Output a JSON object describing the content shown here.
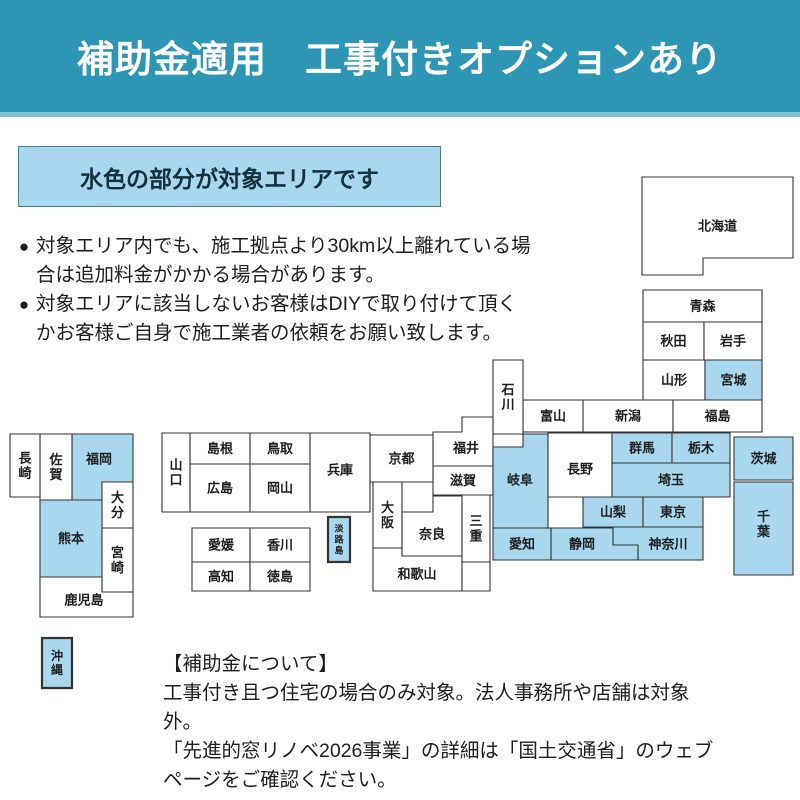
{
  "banner": {
    "title": "補助金適用　工事付きオプションあり"
  },
  "legend": {
    "label": "水色の部分が対象エリアです",
    "meaning": "light-blue boxes = service target area"
  },
  "notes": {
    "items": [
      "対象エリア内でも、施工拠点より30km以上離れている場合は追加料金がかかる場合があります。",
      "対象エリアに該当しないお客様はDIYで取り付けて頂くかお客様ご自身で施工業者の依頼をお願い致します。"
    ],
    "bullet": "●"
  },
  "footer": {
    "heading": "【補助金について】",
    "body": "工事付き且つ住宅の場合のみ対象。法人事務所や店舗は対象外。\n「先進的窓リノベ2026事業」の詳細は「国土交通省」のウェブ\nページをご確認ください。"
  },
  "theme": {
    "banner_bg": "#2e96b5",
    "banner_text": "#ffffff",
    "target_area_fill": "#a9d8ee",
    "default_fill": "#ffffff",
    "border": "#333333",
    "text": "#1e1e1e"
  },
  "map": {
    "description": "schematic block map of Japan prefectures; fill 'target' = covered area",
    "prefectures": [
      {
        "id": "hokkaido",
        "name": "北海道",
        "points": [
          [
            642,
            177
          ],
          [
            793,
            177
          ],
          [
            793,
            258
          ],
          [
            703,
            258
          ],
          [
            703,
            275
          ],
          [
            642,
            275
          ]
        ],
        "fill": "default"
      },
      {
        "id": "aomori",
        "name": "青森",
        "rect": [
          643,
          290,
          762,
          322
        ],
        "fill": "default"
      },
      {
        "id": "akita",
        "name": "秋田",
        "rect": [
          643,
          322,
          704,
          360
        ],
        "fill": "default"
      },
      {
        "id": "iwate",
        "name": "岩手",
        "rect": [
          704,
          322,
          762,
          360
        ],
        "fill": "default"
      },
      {
        "id": "yamagata",
        "name": "山形",
        "rect": [
          643,
          360,
          705,
          400
        ],
        "fill": "default"
      },
      {
        "id": "miyagi",
        "name": "宮城",
        "rect": [
          705,
          360,
          762,
          400
        ],
        "fill": "target"
      },
      {
        "id": "niigata",
        "name": "新潟",
        "rect": [
          583,
          400,
          673,
          432
        ],
        "fill": "default"
      },
      {
        "id": "toyama",
        "name": "富山",
        "rect": [
          523,
          400,
          583,
          432
        ],
        "fill": "default"
      },
      {
        "id": "fukushima",
        "name": "福島",
        "rect": [
          673,
          400,
          762,
          432
        ],
        "fill": "default"
      },
      {
        "id": "ishikawa",
        "name": "石川",
        "rect": [
          493,
          360,
          523,
          434
        ],
        "fill": "default",
        "vertical": true
      },
      {
        "id": "fukui",
        "name": "福井",
        "points": [
          [
            462,
            417
          ],
          [
            493,
            417
          ],
          [
            493,
            466
          ],
          [
            433,
            466
          ],
          [
            433,
            432
          ],
          [
            462,
            432
          ]
        ],
        "fill": "default",
        "lx": 466,
        "ly": 448
      },
      {
        "id": "shiga",
        "name": "滋賀",
        "rect": [
          433,
          466,
          493,
          495
        ],
        "fill": "default"
      },
      {
        "id": "gifu",
        "name": "岐阜",
        "points": [
          [
            523,
            434
          ],
          [
            548,
            434
          ],
          [
            548,
            528
          ],
          [
            493,
            528
          ],
          [
            493,
            447
          ],
          [
            523,
            447
          ]
        ],
        "fill": "target",
        "lx": 520,
        "ly": 480
      },
      {
        "id": "nagano",
        "name": "長野",
        "rect": [
          548,
          433,
          612,
          497
        ],
        "fill": "default",
        "ly": 469
      },
      {
        "id": "gunma",
        "name": "群馬",
        "rect": [
          612,
          433,
          672,
          463
        ],
        "fill": "target"
      },
      {
        "id": "tochigi",
        "name": "栃木",
        "rect": [
          672,
          433,
          730,
          463
        ],
        "fill": "target"
      },
      {
        "id": "ibaraki",
        "name": "茨城",
        "rect": [
          734,
          437,
          793,
          480
        ],
        "fill": "target"
      },
      {
        "id": "saitama",
        "name": "埼玉",
        "rect": [
          612,
          463,
          730,
          497
        ],
        "fill": "target"
      },
      {
        "id": "yamanashi",
        "name": "山梨",
        "rect": [
          583,
          497,
          643,
          527
        ],
        "fill": "target"
      },
      {
        "id": "tokyo",
        "name": "東京",
        "rect": [
          643,
          497,
          703,
          527
        ],
        "fill": "target"
      },
      {
        "id": "chiba",
        "name": "千葉",
        "rect": [
          734,
          482,
          793,
          575
        ],
        "fill": "target",
        "vertical": true,
        "ly": 524
      },
      {
        "id": "kanagawa",
        "name": "神奈川",
        "points": [
          [
            613,
            527
          ],
          [
            703,
            527
          ],
          [
            703,
            560
          ],
          [
            638,
            560
          ],
          [
            638,
            545
          ],
          [
            613,
            545
          ]
        ],
        "fill": "target",
        "lx": 668,
        "ly": 544
      },
      {
        "id": "shizuoka",
        "name": "静岡",
        "points": [
          [
            551,
            528
          ],
          [
            613,
            528
          ],
          [
            613,
            545
          ],
          [
            638,
            545
          ],
          [
            638,
            560
          ],
          [
            551,
            560
          ]
        ],
        "fill": "target",
        "lx": 582,
        "ly": 544
      },
      {
        "id": "aichi",
        "name": "愛知",
        "rect": [
          493,
          528,
          551,
          560
        ],
        "fill": "target"
      },
      {
        "id": "kyoto",
        "name": "京都",
        "rect": [
          370,
          435,
          433,
          482
        ],
        "fill": "default"
      },
      {
        "id": "osaka",
        "name": "大阪",
        "rect": [
          373,
          482,
          402,
          548
        ],
        "fill": "default",
        "vertical": true
      },
      {
        "id": "nara",
        "name": "奈良",
        "points": [
          [
            433,
            496
          ],
          [
            462,
            496
          ],
          [
            462,
            556
          ],
          [
            402,
            556
          ],
          [
            402,
            512
          ],
          [
            433,
            512
          ]
        ],
        "fill": "default",
        "lx": 432,
        "ly": 534
      },
      {
        "id": "wakayama",
        "name": "和歌山",
        "points": [
          [
            373,
            548
          ],
          [
            402,
            548
          ],
          [
            402,
            556
          ],
          [
            462,
            556
          ],
          [
            462,
            591
          ],
          [
            373,
            591
          ]
        ],
        "fill": "default",
        "lx": 417,
        "ly": 574
      },
      {
        "id": "mie",
        "name": "三重",
        "rect": [
          462,
          495,
          490,
          562
        ],
        "fill": "default",
        "vertical": true
      },
      {
        "id": "mie-south",
        "name": "",
        "rect": [
          462,
          562,
          490,
          591
        ],
        "fill": "default"
      },
      {
        "id": "hyogo",
        "name": "兵庫",
        "rect": [
          310,
          433,
          370,
          512
        ],
        "fill": "default",
        "ly": 470
      },
      {
        "id": "awajishima",
        "name": "淡路島",
        "rect": [
          328,
          517,
          350,
          562
        ],
        "fill": "target",
        "vertical": true,
        "fs": 9,
        "thick": true
      },
      {
        "id": "shimane",
        "name": "島根",
        "rect": [
          190,
          433,
          250,
          464
        ],
        "fill": "default"
      },
      {
        "id": "tottori",
        "name": "鳥取",
        "rect": [
          250,
          433,
          310,
          464
        ],
        "fill": "default"
      },
      {
        "id": "hiroshima",
        "name": "広島",
        "rect": [
          190,
          464,
          250,
          512
        ],
        "fill": "default"
      },
      {
        "id": "okayama",
        "name": "岡山",
        "rect": [
          250,
          464,
          310,
          512
        ],
        "fill": "default"
      },
      {
        "id": "yamaguchi",
        "name": "山口",
        "rect": [
          162,
          433,
          190,
          512
        ],
        "fill": "default",
        "vertical": true
      },
      {
        "id": "ehime",
        "name": "愛媛",
        "rect": [
          192,
          528,
          250,
          562
        ],
        "fill": "default"
      },
      {
        "id": "kagawa",
        "name": "香川",
        "rect": [
          250,
          528,
          310,
          562
        ],
        "fill": "default"
      },
      {
        "id": "kochi",
        "name": "高知",
        "rect": [
          192,
          562,
          250,
          591
        ],
        "fill": "default"
      },
      {
        "id": "tokushima",
        "name": "徳島",
        "rect": [
          250,
          562,
          310,
          591
        ],
        "fill": "default"
      },
      {
        "id": "fukuoka",
        "name": "福岡",
        "points": [
          [
            72,
            434
          ],
          [
            133,
            434
          ],
          [
            133,
            482
          ],
          [
            102,
            482
          ],
          [
            102,
            500
          ],
          [
            72,
            500
          ]
        ],
        "fill": "target",
        "lx": 99,
        "ly": 459
      },
      {
        "id": "saga",
        "name": "佐賀",
        "rect": [
          40,
          434,
          72,
          500
        ],
        "fill": "default",
        "vertical": true
      },
      {
        "id": "nagasaki",
        "name": "長崎",
        "rect": [
          10,
          434,
          40,
          497
        ],
        "fill": "default",
        "vertical": true
      },
      {
        "id": "oita",
        "name": "大分",
        "rect": [
          102,
          482,
          133,
          528
        ],
        "fill": "default",
        "vertical": true
      },
      {
        "id": "kumamoto",
        "name": "熊本",
        "rect": [
          40,
          500,
          102,
          577
        ],
        "fill": "target"
      },
      {
        "id": "miyazaki",
        "name": "宮崎",
        "rect": [
          102,
          528,
          133,
          592
        ],
        "fill": "default",
        "vertical": true
      },
      {
        "id": "kagoshima",
        "name": "鹿児島",
        "points": [
          [
            40,
            577
          ],
          [
            102,
            577
          ],
          [
            102,
            592
          ],
          [
            133,
            592
          ],
          [
            133,
            617
          ],
          [
            40,
            617
          ]
        ],
        "fill": "default",
        "lx": 84,
        "ly": 600
      },
      {
        "id": "okinawa",
        "name": "沖縄",
        "rect": [
          42,
          638,
          72,
          688
        ],
        "fill": "target",
        "vertical": true,
        "thick": true,
        "fs": 12
      }
    ]
  }
}
